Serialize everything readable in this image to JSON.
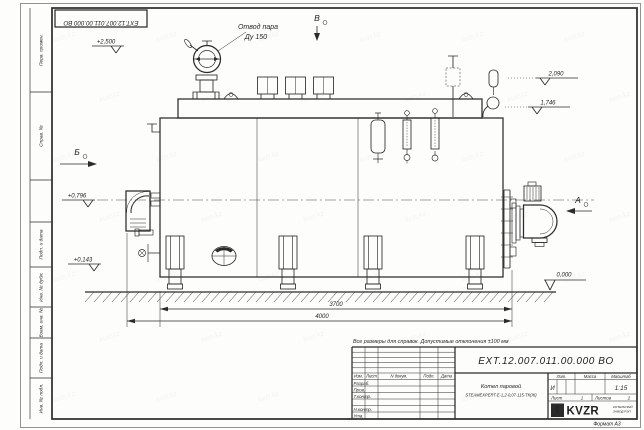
{
  "sheet": {
    "note": "Все размеры для справок. Допустимые отклонения ±100 мм",
    "format_label": "Формат А3",
    "watermark": "kvzr.kz"
  },
  "colors": {
    "line": "#2b2b2b",
    "paper": "#fdfdfb",
    "watermark": "#40646e"
  },
  "frame_columns": {
    "perv_primen": "Перв. примен.",
    "sprav_no": "Справ. №",
    "podp_data1": "Подп. и дата",
    "inv_dubl": "Инв. № дубл.",
    "vzam_inv": "Взам. инв. №",
    "podp_data2": "Подп. и дата",
    "inv_podl": "Инв. № подл."
  },
  "drawing": {
    "steam_label1": "Отвод пара",
    "steam_label2": "Ду 150",
    "e2500": "+2,500",
    "e2090": "2,090",
    "e1746": "1,746",
    "e0796": "+0,796",
    "e0143": "+0,143",
    "e0000": "0,000",
    "view_b": "Б",
    "view_v": "В",
    "view_a": "А",
    "dim_3700": "3700",
    "dim_4000": "4000"
  },
  "title_block": {
    "doc_number": "ЕХТ.12.007.011.00.000  ВО",
    "product_line1": "Котел паровой",
    "product_line2": "STEAMEXPERT-E-1,2-0,07-115-ТК(Ж)",
    "col_izm": "Изм.",
    "col_list": "Лист",
    "col_doc": "N докум.",
    "col_sign": "Подп.",
    "col_date": "Дата",
    "row_dev": "Разраб.",
    "row_check": "Пров.",
    "row_tcontr": "Т.контр.",
    "row_ncontr": "Н.контр.",
    "row_appr": "Утв.",
    "lit_header": "Лит.",
    "mass_header": "Масса",
    "scale_header": "Масштаб",
    "lit_value": "И",
    "scale_value": "1:15",
    "sheet_label": "Лист",
    "sheet_value": "1",
    "sheets_label": "Листов",
    "sheets_value": "2",
    "logo_mark": "КВЗР",
    "logo_text": "KVZR",
    "logo_line1": "КОТЕЛЬНЫЙ",
    "logo_line2": "ЗАВОД РЭП"
  }
}
